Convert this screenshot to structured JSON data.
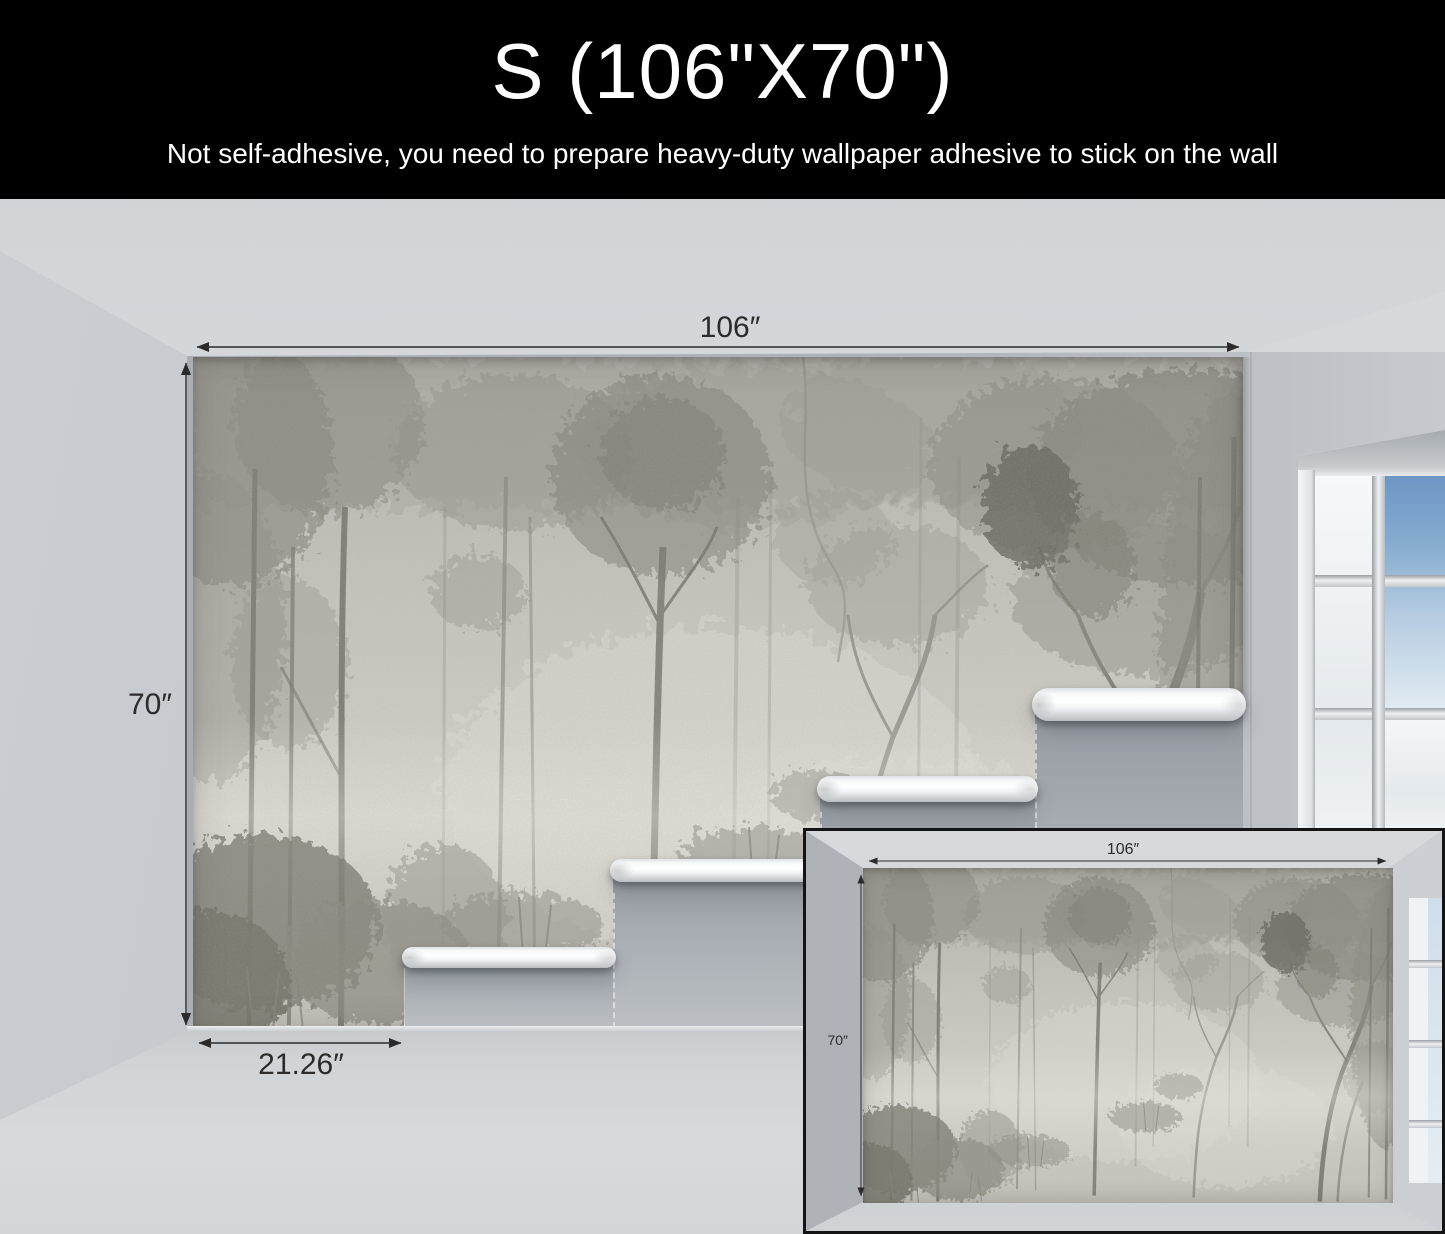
{
  "header": {
    "title": "S (106\"X70\")",
    "subtitle": "Not self-adhesive, you need to prepare heavy-duty wallpaper adhesive to stick on the wall"
  },
  "dimensions": {
    "main": {
      "width": "106″",
      "height": "70″",
      "strip_width": "21.26″"
    },
    "inset": {
      "width": "106″",
      "height": "70″"
    }
  },
  "colors": {
    "header_bg": "#000000",
    "header_text": "#ffffff",
    "annotation_line": "#2b2b2b",
    "bare_wall": "#a9aeb4",
    "mural_base": "#c8c5bf",
    "mural_tree": "#85847c",
    "roll_white": "#fafbfc",
    "window_sky": "#6b94c4"
  }
}
